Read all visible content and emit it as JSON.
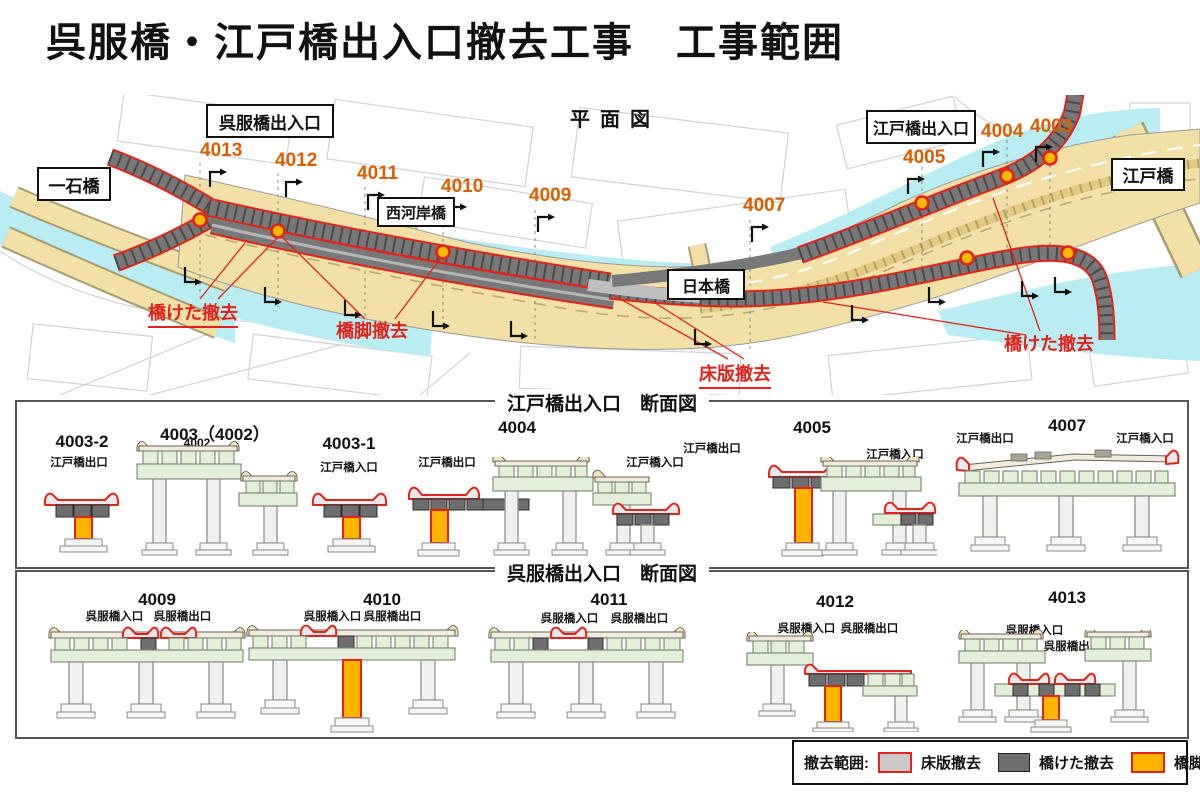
{
  "title": "呉服橋・江戸橋出入口撤去工事　工事範囲",
  "plan": {
    "heading": "平面図",
    "bridge_labels": [
      {
        "id": "gofukubashi-ramp",
        "text": "呉服橋出入口"
      },
      {
        "id": "edobashi-ramp",
        "text": "江戸橋出入口"
      },
      {
        "id": "ichikokubashi",
        "text": "一石橋"
      },
      {
        "id": "nishikashibashi",
        "text": "西河岸橋"
      },
      {
        "id": "nihonbashi",
        "text": "日本橋"
      },
      {
        "id": "edobashi",
        "text": "江戸橋"
      }
    ],
    "numbers": [
      {
        "text": "4013"
      },
      {
        "text": "4012"
      },
      {
        "text": "4011"
      },
      {
        "text": "4010"
      },
      {
        "text": "4009"
      },
      {
        "text": "4007"
      },
      {
        "text": "4005"
      },
      {
        "text": "4004"
      },
      {
        "text": "4003"
      }
    ],
    "notes": [
      {
        "text": "橋けた撤去"
      },
      {
        "text": "橋脚撤去"
      },
      {
        "text": "床版撤去"
      },
      {
        "text": "橋けた撤去"
      }
    ]
  },
  "edobashi_sections": {
    "title": "江戸橋出入口　断面図",
    "groups": [
      {
        "id": "4003-2",
        "exit": "江戸橋出口"
      },
      {
        "id": "4003（4002）",
        "sub": "4002"
      },
      {
        "id": "4003-1",
        "entrance": "江戸橋入口"
      },
      {
        "id": "4004",
        "exit": "江戸橋出口",
        "entrance": "江戸橋入口"
      },
      {
        "id": "4005",
        "exit": "江戸橋出口",
        "entrance": "江戸橋入口"
      },
      {
        "id": "4007",
        "exit": "江戸橋出口",
        "entrance": "江戸橋入口"
      }
    ]
  },
  "gofukubashi_sections": {
    "title": "呉服橋出入口　断面図",
    "groups": [
      {
        "id": "4009",
        "entrance": "呉服橋入口",
        "exit": "呉服橋出口"
      },
      {
        "id": "4010",
        "entrance": "呉服橋入口",
        "exit": "呉服橋出口"
      },
      {
        "id": "4011",
        "entrance": "呉服橋入口",
        "exit": "呉服橋出口"
      },
      {
        "id": "4012",
        "entrance": "呉服橋入口",
        "exit": "呉服橋出口"
      },
      {
        "id": "4013",
        "entrance": "呉服橋入口",
        "exit": "呉服橋出口"
      }
    ]
  },
  "legend": {
    "label": "撤去範囲:",
    "items": [
      {
        "label": "床版撤去",
        "fill": "#c9c9c9",
        "border": "#e3231a"
      },
      {
        "label": "橋けた撤去",
        "fill": "#6e6e6e",
        "border": "#222222"
      },
      {
        "label": "橋脚撤去",
        "fill": "#ffb400",
        "border": "#e3231a"
      }
    ]
  },
  "colors": {
    "number_orange": "#d95f00",
    "note_red": "#e3231a",
    "river_cyan": "#b9edf3",
    "road_tan": "#f2e0a6",
    "ramp_gray": "#787878",
    "pier_orange": "#ffb400",
    "girder_gray": "#6e6e6e"
  }
}
